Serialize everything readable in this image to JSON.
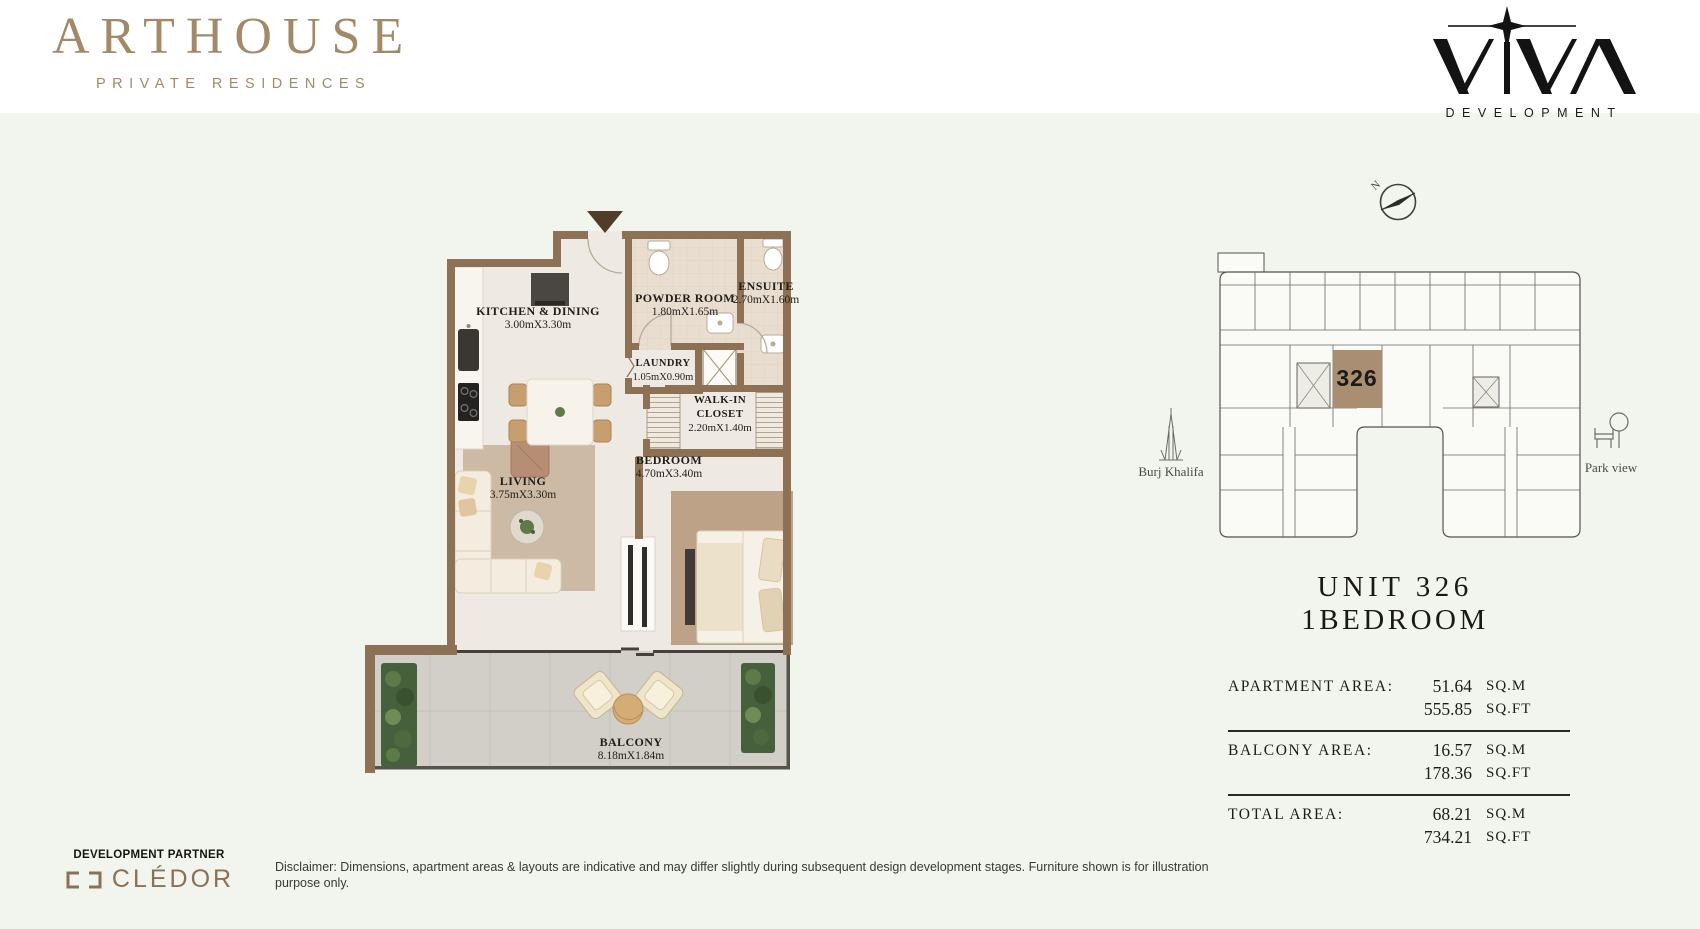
{
  "colors": {
    "background": "#f1f5ee",
    "brand": "#a28a68",
    "wall_brown": "#8d7154",
    "unit_highlight": "#a98e72",
    "ink": "#1d1b17"
  },
  "header": {
    "brand_name": "ARTHOUSE",
    "brand_tagline": "PRIVATE RESIDENCES",
    "developer_name": "VIVA",
    "developer_subtitle": "DEVELOPMENT"
  },
  "floor_plan": {
    "rooms": [
      {
        "name": "KITCHEN & DINING",
        "dimensions": "3.00mX3.30m"
      },
      {
        "name": "POWDER ROOM",
        "dimensions": "1.80mX1.65m"
      },
      {
        "name": "ENSUITE",
        "dimensions": "2.70mX1.60m"
      },
      {
        "name": "LAUNDRY",
        "dimensions": "1.05mX0.90m"
      },
      {
        "name": "WALK-IN CLOSET",
        "dimensions": "2.20mX1.40m"
      },
      {
        "name": "LIVING",
        "dimensions": "3.75mX3.30m"
      },
      {
        "name": "BEDROOM",
        "dimensions": "4.70mX3.40m"
      },
      {
        "name": "BALCONY",
        "dimensions": "8.18mX1.84m"
      }
    ]
  },
  "key_plan": {
    "compass_label": "N",
    "unit_number": "326",
    "left_landmark": "Burj Khalifa",
    "right_landmark": "Park view"
  },
  "unit_info": {
    "title": "UNIT 326",
    "type": "1BEDROOM",
    "areas": [
      {
        "label": "APARTMENT AREA:",
        "sqm_value": "51.64",
        "sqm_unit": "SQ.M",
        "sqft_value": "555.85",
        "sqft_unit": "SQ.FT"
      },
      {
        "label": "BALCONY AREA:",
        "sqm_value": "16.57",
        "sqm_unit": "SQ.M",
        "sqft_value": "178.36",
        "sqft_unit": "SQ.FT"
      },
      {
        "label": "TOTAL AREA:",
        "sqm_value": "68.21",
        "sqm_unit": "SQ.M",
        "sqft_value": "734.21",
        "sqft_unit": "SQ.FT"
      }
    ]
  },
  "footer": {
    "partner_label": "DEVELOPMENT PARTNER",
    "partner_name": "CLÉDOR",
    "disclaimer": "Disclaimer: Dimensions, apartment areas & layouts are indicative and may differ slightly during subsequent design development stages. Furniture shown is for illustration purpose only."
  }
}
